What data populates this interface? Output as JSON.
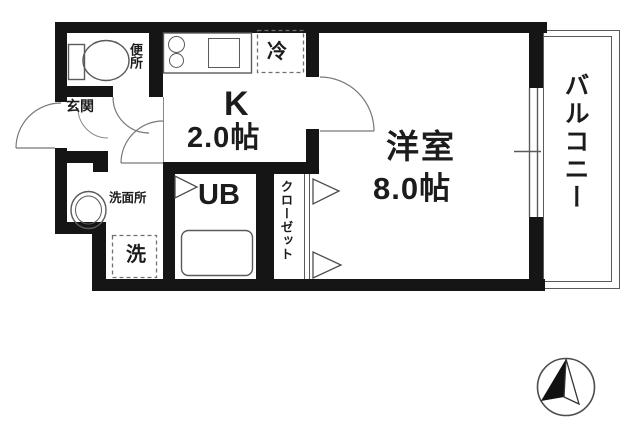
{
  "rooms": {
    "toilet": {
      "label": "便所"
    },
    "entrance": {
      "label": "玄関"
    },
    "kitchen": {
      "label": "K",
      "size": "2.0帖"
    },
    "refrigerator_space": {
      "label": "冷"
    },
    "western_room": {
      "label": "洋室",
      "size": "8.0帖"
    },
    "unit_bath": {
      "label": "UB"
    },
    "washroom": {
      "label": "洗面所"
    },
    "washing_machine_space": {
      "label": "洗"
    },
    "closet": {
      "label": "クローゼット"
    },
    "balcony": {
      "label": "バルコニー"
    }
  },
  "colors": {
    "wall": "#151515",
    "line": "#5a5a5a",
    "dashed_line": "#707070",
    "text": "#1c1c1c",
    "background": "#ffffff"
  }
}
